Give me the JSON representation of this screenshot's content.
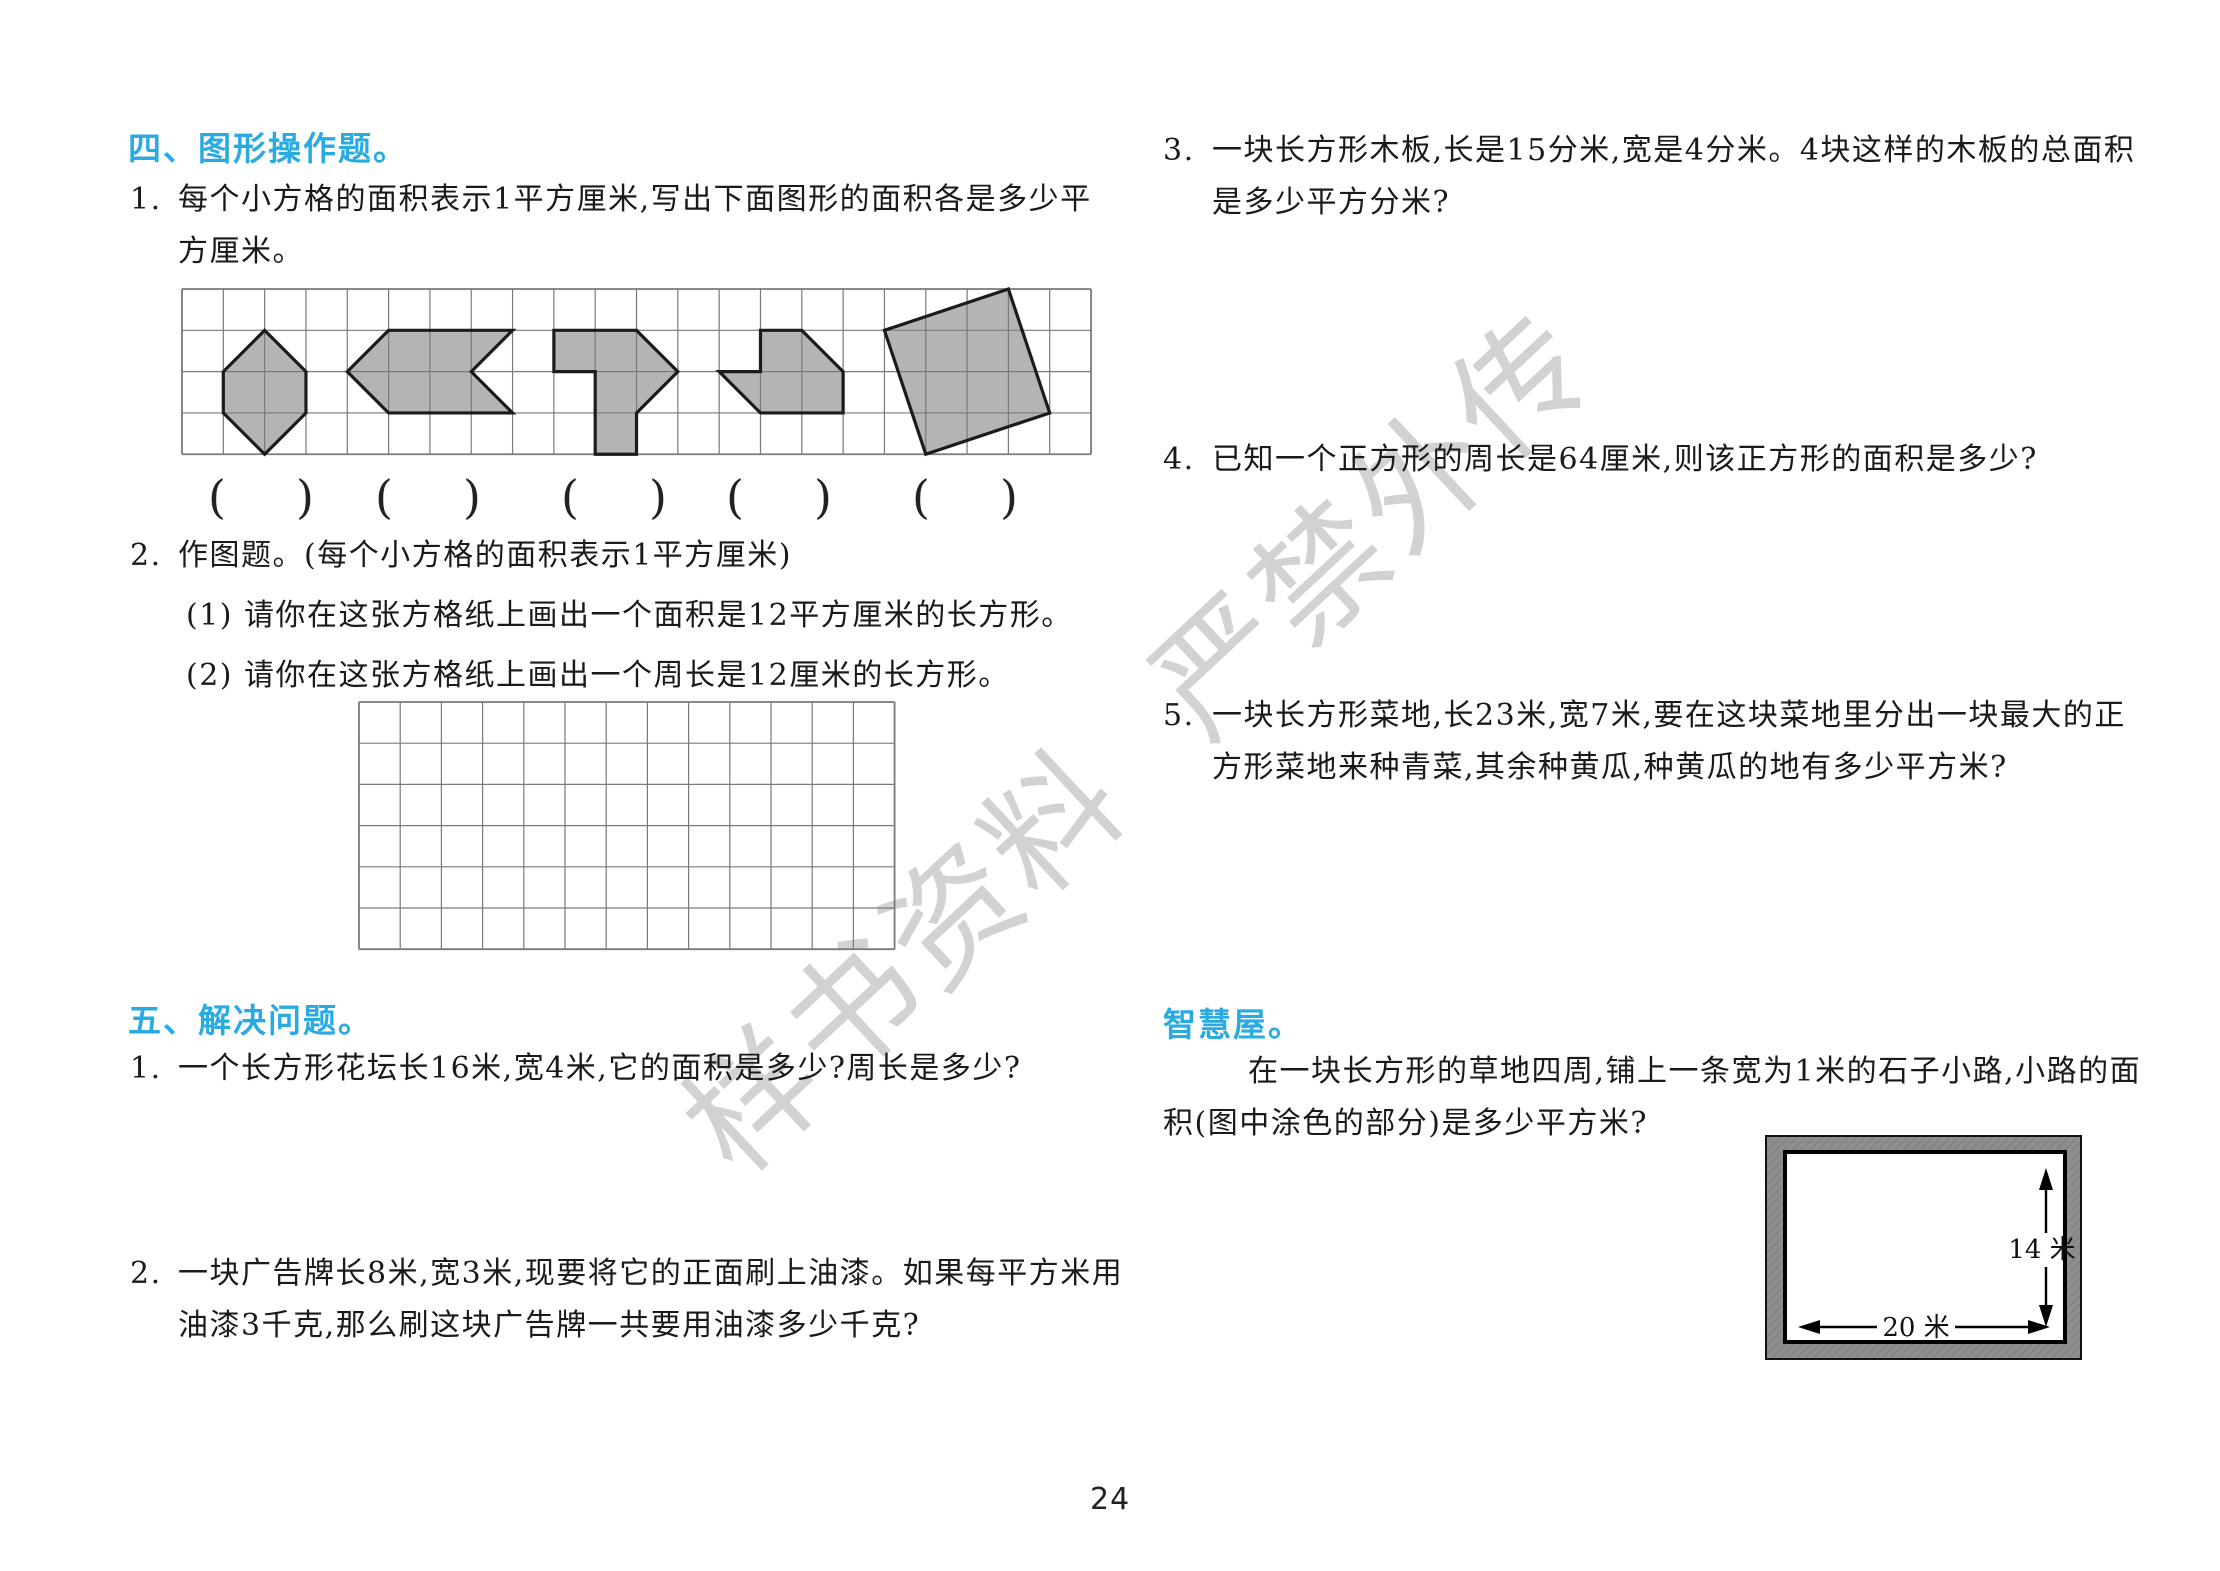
{
  "watermark": {
    "text": "样书资料 严禁外传"
  },
  "colors": {
    "accent_blue": "#29abe2",
    "shape_fill": "#b4b4b4",
    "shape_stroke": "#1b1b1b",
    "grid_line": "#7a7a7a",
    "road_gray": "#8e8e8e"
  },
  "section4": {
    "heading": "四、图形操作题。",
    "q1": {
      "number": "1.",
      "line1": "每个小方格的面积表示1平方厘米,写出下面图形的面积各是多少平",
      "line2": "方厘米。"
    },
    "paren_open": "(",
    "paren_close": ")",
    "q2": {
      "number": "2.",
      "text": "作图题。(每个小方格的面积表示1平方厘米)",
      "sub1": "(1) 请你在这张方格纸上画出一个面积是12平方厘米的长方形。",
      "sub2": "(2) 请你在这张方格纸上画出一个周长是12厘米的长方形。"
    }
  },
  "section5": {
    "heading": "五、解决问题。",
    "q1": {
      "number": "1.",
      "text": "一个长方形花坛长16米,宽4米,它的面积是多少?周长是多少?"
    },
    "q2": {
      "number": "2.",
      "line1": "一块广告牌长8米,宽3米,现要将它的正面刷上油漆。如果每平方米用",
      "line2": "油漆3千克,那么刷这块广告牌一共要用油漆多少千克?"
    },
    "q3": {
      "number": "3.",
      "line1": "一块长方形木板,长是15分米,宽是4分米。4块这样的木板的总面积",
      "line2": "是多少平方分米?"
    },
    "q4": {
      "number": "4.",
      "text": "已知一个正方形的周长是64厘米,则该正方形的面积是多少?"
    },
    "q5": {
      "number": "5.",
      "line1": "一块长方形菜地,长23米,宽7米,要在这块菜地里分出一块最大的正",
      "line2": "方形菜地来种青菜,其余种黄瓜,种黄瓜的地有多少平方米?"
    }
  },
  "wisdom": {
    "heading": "智慧屋。",
    "line1": "在一块长方形的草地四周,铺上一条宽为1米的石子小路,小路的面",
    "line2": "积(图中涂色的部分)是多少平方米?",
    "diagram": {
      "width_label": "20 米",
      "height_label": "14 米"
    }
  },
  "page": {
    "number": "24"
  },
  "figures": {
    "grid1": {
      "x": 180,
      "y": 287,
      "cols": 22,
      "rows": 4,
      "cell": 41.32,
      "shapes": [
        [
          [
            2,
            1
          ],
          [
            3,
            2
          ],
          [
            3,
            3
          ],
          [
            2,
            4
          ],
          [
            1,
            3
          ],
          [
            1,
            2
          ]
        ],
        [
          [
            4,
            2
          ],
          [
            5,
            1
          ],
          [
            8,
            1
          ],
          [
            7,
            2
          ],
          [
            8,
            3
          ],
          [
            5,
            3
          ]
        ],
        [
          [
            9,
            1
          ],
          [
            11,
            1
          ],
          [
            12,
            2
          ],
          [
            11,
            3
          ],
          [
            11,
            4
          ],
          [
            10,
            4
          ],
          [
            10,
            2
          ],
          [
            9,
            2
          ]
        ],
        [
          [
            14,
            1
          ],
          [
            15,
            1
          ],
          [
            16,
            2
          ],
          [
            16,
            3
          ],
          [
            14,
            3
          ],
          [
            13,
            2
          ],
          [
            14,
            2
          ]
        ],
        [
          [
            17,
            1
          ],
          [
            20,
            0
          ],
          [
            21,
            3
          ],
          [
            18,
            4
          ]
        ]
      ]
    },
    "grid2": {
      "x": 357,
      "y": 700,
      "cols": 13,
      "rows": 6,
      "cell": 41.2
    },
    "paren_centers": [
      261,
      428,
      614,
      779,
      965
    ],
    "paren_top": 474,
    "road_diagram": {
      "x": 1765,
      "y": 1135,
      "w": 317,
      "h": 225,
      "inner": {
        "x": 20,
        "y": 17,
        "w": 280,
        "h": 190
      },
      "vline_x": 281,
      "vline_y1": 33,
      "vline_y2": 192,
      "hline_y": 192,
      "hline_x1": 33,
      "hline_x2": 285
    }
  }
}
